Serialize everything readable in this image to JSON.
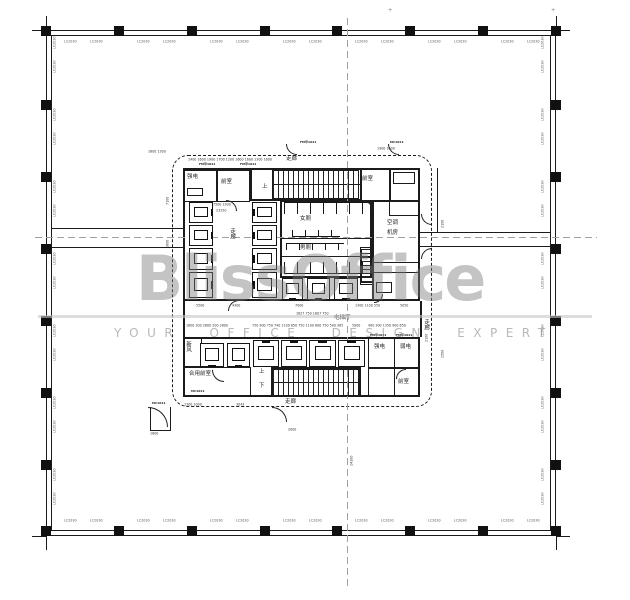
{
  "watermark": {
    "brand": "BlissOffice",
    "tagline": "YOUR OFFICE DESIGN EXPERT",
    "color": "#7d7d7d"
  },
  "colors": {
    "line": "#1b1b1b",
    "thin": "#333333",
    "centerline": "#a0a0a0",
    "tag": "#555555",
    "watermark_bar": "#c6c6c6"
  },
  "plan": {
    "building": {
      "outer_rect": [
        46,
        30,
        510,
        506,
        1.2
      ],
      "inner_rect": [
        51,
        35,
        500,
        496,
        0.8
      ]
    },
    "rects": [
      {
        "x": 183,
        "y": 168,
        "w": 237,
        "h": 133,
        "t": 2.5,
        "n": "core-top-block"
      },
      {
        "x": 183,
        "y": 337,
        "w": 237,
        "h": 60,
        "t": 2.5,
        "n": "core-bottom-band"
      },
      {
        "x": 183,
        "y": 170,
        "w": 34,
        "h": 32,
        "t": 1.8,
        "n": "room-strong-electric"
      },
      {
        "x": 217,
        "y": 170,
        "w": 33,
        "h": 32,
        "t": 1.8,
        "n": "room-anteroom"
      },
      {
        "x": 250,
        "y": 168,
        "w": 112,
        "h": 33,
        "t": 2,
        "n": "stair-top-box"
      },
      {
        "x": 360,
        "y": 168,
        "w": 31,
        "h": 33,
        "t": 1.8,
        "n": "room-anteroom-right"
      },
      {
        "x": 389,
        "y": 168,
        "w": 31,
        "h": 48,
        "t": 1.8,
        "n": "room-shaft-right"
      },
      {
        "x": 280,
        "y": 200,
        "w": 92,
        "h": 78,
        "t": 2,
        "n": "toilet-zone"
      },
      {
        "x": 372,
        "y": 200,
        "w": 48,
        "h": 101,
        "t": 2.2,
        "n": "room-ac-plant"
      },
      {
        "x": 360,
        "y": 247,
        "w": 14,
        "h": 38,
        "t": 1.5,
        "n": "shaft-small"
      },
      {
        "x": 183,
        "y": 337,
        "w": 19,
        "h": 30,
        "t": 1.6,
        "n": "room-fresh-air"
      },
      {
        "x": 183,
        "y": 367,
        "w": 68,
        "h": 30,
        "t": 1.8,
        "n": "room-shared-anteroom"
      },
      {
        "x": 368,
        "y": 337,
        "w": 27,
        "h": 31,
        "t": 1.8,
        "n": "room-strong-electric-2"
      },
      {
        "x": 394,
        "y": 337,
        "w": 26,
        "h": 31,
        "t": 1.8,
        "n": "room-weak-electric"
      },
      {
        "x": 368,
        "y": 368,
        "w": 27,
        "h": 29,
        "t": 1.6,
        "n": "room-pantry"
      },
      {
        "x": 394,
        "y": 368,
        "w": 26,
        "h": 29,
        "t": 1.6,
        "n": "room-anteroom-bottom"
      },
      {
        "x": 271,
        "y": 367,
        "w": 90,
        "h": 30,
        "t": 2,
        "n": "stair-bottom-box"
      },
      {
        "x": 187,
        "y": 188,
        "w": 16,
        "h": 8,
        "t": 1,
        "n": "equipment-box"
      },
      {
        "x": 393,
        "y": 172,
        "w": 22,
        "h": 12,
        "t": 1,
        "n": "equipment-box"
      },
      {
        "x": 376,
        "y": 282,
        "w": 16,
        "h": 11,
        "t": 1.2,
        "n": "equipment-box"
      }
    ],
    "dashed_rect": {
      "x": 172,
      "y": 155,
      "w": 260,
      "h": 252,
      "n": "smoke-control-dashed-line"
    },
    "hlines": [
      [
        51,
        228,
        132,
        1.4
      ],
      [
        51,
        247,
        132,
        1.0
      ],
      [
        420,
        232,
        131,
        1.4
      ],
      [
        420,
        246,
        131,
        1.0
      ],
      [
        272,
        184,
        88,
        1.0
      ],
      [
        272,
        382,
        88,
        1.0
      ],
      [
        280,
        238,
        92,
        1.0
      ],
      [
        280,
        256,
        92,
        0.8
      ],
      [
        374,
        262,
        44,
        0.8
      ],
      [
        374,
        272,
        44,
        0.8
      ],
      [
        32,
        30,
        14,
        1.0
      ],
      [
        556,
        30,
        14,
        1.0
      ],
      [
        32,
        536,
        14,
        1.0
      ],
      [
        556,
        536,
        14,
        1.0
      ],
      [
        150,
        430,
        20,
        0.8
      ]
    ],
    "vlines": [
      [
        46,
        16,
        14,
        1.0
      ],
      [
        556,
        16,
        14,
        1.0
      ],
      [
        46,
        536,
        14,
        1.0
      ],
      [
        556,
        536,
        14,
        1.0
      ],
      [
        437,
        168,
        65,
        1.2
      ],
      [
        183,
        301,
        36,
        2.0
      ],
      [
        420,
        301,
        36,
        2.0
      ],
      [
        150,
        407,
        24,
        1.0
      ],
      [
        170,
        407,
        24,
        1.0
      ]
    ],
    "centerlines": {
      "v": [
        347,
        18,
        570
      ],
      "h": [
        35,
        237,
        562
      ]
    },
    "columns": {
      "top_y": 26,
      "bottom_y": 526,
      "left_x": 41,
      "right_x": 551,
      "size": 10,
      "xs": [
        46,
        119,
        192,
        265,
        337,
        410,
        483,
        556
      ],
      "ys": [
        33,
        105,
        177,
        249,
        321,
        393,
        465,
        533
      ]
    },
    "window_tags": {
      "text": "LC2030",
      "items": [
        [
          64,
          40,
          0
        ],
        [
          90,
          40,
          0
        ],
        [
          137,
          40,
          0
        ],
        [
          163,
          40,
          0
        ],
        [
          210,
          40,
          0
        ],
        [
          236,
          40,
          0
        ],
        [
          283,
          40,
          0
        ],
        [
          309,
          40,
          0
        ],
        [
          355,
          40,
          0
        ],
        [
          381,
          40,
          0
        ],
        [
          428,
          40,
          0
        ],
        [
          454,
          40,
          0
        ],
        [
          501,
          40,
          0
        ],
        [
          527,
          40,
          0
        ],
        [
          64,
          519,
          0
        ],
        [
          90,
          519,
          0
        ],
        [
          137,
          519,
          0
        ],
        [
          163,
          519,
          0
        ],
        [
          210,
          519,
          0
        ],
        [
          236,
          519,
          0
        ],
        [
          283,
          519,
          0
        ],
        [
          309,
          519,
          0
        ],
        [
          355,
          519,
          0
        ],
        [
          381,
          519,
          0
        ],
        [
          428,
          519,
          0
        ],
        [
          454,
          519,
          0
        ],
        [
          501,
          519,
          0
        ],
        [
          527,
          519,
          0
        ],
        [
          53,
          49,
          1
        ],
        [
          53,
          73,
          1
        ],
        [
          53,
          121,
          1
        ],
        [
          53,
          145,
          1
        ],
        [
          53,
          193,
          1
        ],
        [
          53,
          217,
          1
        ],
        [
          53,
          265,
          1
        ],
        [
          53,
          289,
          1
        ],
        [
          53,
          337,
          1
        ],
        [
          53,
          361,
          1
        ],
        [
          53,
          409,
          1
        ],
        [
          53,
          433,
          1
        ],
        [
          53,
          481,
          1
        ],
        [
          53,
          505,
          1
        ],
        [
          541,
          49,
          1
        ],
        [
          541,
          73,
          1
        ],
        [
          541,
          121,
          1
        ],
        [
          541,
          145,
          1
        ],
        [
          541,
          193,
          1
        ],
        [
          541,
          217,
          1
        ],
        [
          541,
          265,
          1
        ],
        [
          541,
          289,
          1
        ],
        [
          541,
          337,
          1
        ],
        [
          541,
          361,
          1
        ],
        [
          541,
          409,
          1
        ],
        [
          541,
          433,
          1
        ],
        [
          541,
          481,
          1
        ],
        [
          541,
          505,
          1
        ]
      ]
    },
    "stairs": [
      {
        "x": 272,
        "y": 170,
        "w": 87,
        "h": 29,
        "dir": "v",
        "n": "stair-top"
      },
      {
        "x": 272,
        "y": 369,
        "w": 87,
        "h": 27,
        "dir": "v",
        "n": "stair-bottom"
      },
      {
        "x": 361,
        "y": 249,
        "w": 12,
        "h": 34,
        "dir": "h",
        "n": "stair-side"
      }
    ],
    "elevators": [
      {
        "x": 189,
        "y": 202,
        "w": 24,
        "h": 21,
        "d": "right"
      },
      {
        "x": 189,
        "y": 225,
        "w": 24,
        "h": 21,
        "d": "right"
      },
      {
        "x": 189,
        "y": 248,
        "w": 24,
        "h": 22,
        "d": "right"
      },
      {
        "x": 189,
        "y": 272,
        "w": 24,
        "h": 26,
        "d": "right"
      },
      {
        "x": 252,
        "y": 202,
        "w": 25,
        "h": 21,
        "d": "left"
      },
      {
        "x": 252,
        "y": 225,
        "w": 25,
        "h": 21,
        "d": "left"
      },
      {
        "x": 252,
        "y": 248,
        "w": 25,
        "h": 22,
        "d": "left"
      },
      {
        "x": 252,
        "y": 272,
        "w": 25,
        "h": 26,
        "d": "left"
      },
      {
        "x": 282,
        "y": 278,
        "w": 21,
        "h": 22,
        "d": "down"
      },
      {
        "x": 307,
        "y": 278,
        "w": 23,
        "h": 22,
        "d": "down"
      },
      {
        "x": 334,
        "y": 278,
        "w": 24,
        "h": 22,
        "d": "down"
      },
      {
        "x": 253,
        "y": 340,
        "w": 26,
        "h": 27,
        "d": "up"
      },
      {
        "x": 281,
        "y": 340,
        "w": 26,
        "h": 27,
        "d": "up"
      },
      {
        "x": 309,
        "y": 340,
        "w": 27,
        "h": 27,
        "d": "up"
      },
      {
        "x": 338,
        "y": 340,
        "w": 27,
        "h": 27,
        "d": "up"
      },
      {
        "x": 200,
        "y": 343,
        "w": 24,
        "h": 24,
        "d": "down"
      },
      {
        "x": 227,
        "y": 343,
        "w": 23,
        "h": 24,
        "d": "down"
      }
    ],
    "combs": [
      {
        "x": 284,
        "y": 202,
        "w": 86,
        "h": 12,
        "side": "t",
        "n": "toilet-stalls-women"
      },
      {
        "x": 292,
        "y": 230,
        "w": 48,
        "h": 7,
        "side": "b",
        "n": "toilet-sinks"
      },
      {
        "x": 286,
        "y": 243,
        "w": 58,
        "h": 7,
        "side": "t",
        "n": "toilet-urinals"
      },
      {
        "x": 284,
        "y": 262,
        "w": 86,
        "h": 12,
        "side": "b",
        "n": "toilet-stalls-men"
      }
    ],
    "arcs": [
      [
        286,
        144,
        11,
        "bl"
      ],
      [
        388,
        144,
        11,
        "bl"
      ],
      [
        272,
        407,
        15,
        "tr"
      ],
      [
        148,
        407,
        20,
        "tr"
      ],
      [
        421,
        214,
        11,
        "bl"
      ],
      [
        421,
        248,
        11,
        "tl"
      ],
      [
        226,
        200,
        11,
        "tr"
      ],
      [
        362,
        200,
        11,
        "tr"
      ],
      [
        212,
        370,
        12,
        "bl"
      ],
      [
        396,
        369,
        10,
        "tl"
      ],
      [
        228,
        300,
        11,
        "tl"
      ],
      [
        374,
        294,
        9,
        "br"
      ]
    ],
    "room_labels": [
      {
        "t": "强电",
        "x": 187,
        "y": 174
      },
      {
        "t": "前室",
        "x": 221,
        "y": 179
      },
      {
        "t": "走廊",
        "x": 286,
        "y": 156
      },
      {
        "t": "上",
        "x": 262,
        "y": 184
      },
      {
        "t": "前室",
        "x": 362,
        "y": 176
      },
      {
        "t": "走廊",
        "x": 229,
        "y": 228,
        "v": 1
      },
      {
        "t": "女厕",
        "x": 300,
        "y": 216
      },
      {
        "t": "男厕",
        "x": 300,
        "y": 245
      },
      {
        "t": "空调",
        "x": 387,
        "y": 220
      },
      {
        "t": "机房",
        "x": 387,
        "y": 230
      },
      {
        "t": "强电",
        "x": 374,
        "y": 344
      },
      {
        "t": "弱电",
        "x": 400,
        "y": 344
      },
      {
        "t": "前室",
        "x": 398,
        "y": 379
      },
      {
        "t": "合用前室",
        "x": 189,
        "y": 371
      },
      {
        "t": "上",
        "x": 259,
        "y": 369
      },
      {
        "t": "下",
        "x": 259,
        "y": 383
      },
      {
        "t": "走廊",
        "x": 285,
        "y": 399
      },
      {
        "t": "走廊",
        "x": 423,
        "y": 319,
        "v": 1
      },
      {
        "t": "电梯厅",
        "x": 334,
        "y": 315
      },
      {
        "t": "新风",
        "x": 185,
        "y": 341,
        "v": 1
      }
    ],
    "dim_texts": [
      {
        "t": "1400 1600 1900 1700 1200 1600 1600 1300 1600",
        "x": 188,
        "y": 158
      },
      {
        "t": "5500",
        "x": 196,
        "y": 304
      },
      {
        "t": "4300",
        "x": 232,
        "y": 304
      },
      {
        "t": "7000",
        "x": 295,
        "y": 304
      },
      {
        "t": "1300 1100 550",
        "x": 355,
        "y": 304
      },
      {
        "t": "5050",
        "x": 400,
        "y": 304
      },
      {
        "t": "1627 750 1607 750",
        "x": 296,
        "y": 312
      },
      {
        "t": "1800 200 2800 200 2800",
        "x": 186,
        "y": 324
      },
      {
        "t": "750 900 750 740 1100 850 750 1100 800 750 500 365",
        "x": 252,
        "y": 324
      },
      {
        "t": "5000",
        "x": 352,
        "y": 324
      },
      {
        "t": "400 300 1350 900 650",
        "x": 368,
        "y": 324
      },
      {
        "t": "2000",
        "x": 288,
        "y": 428
      },
      {
        "t": "1800",
        "x": 150,
        "y": 432
      },
      {
        "t": "1300 1000",
        "x": 184,
        "y": 403
      },
      {
        "t": "3043",
        "x": 236,
        "y": 403
      },
      {
        "t": "1900 1600",
        "x": 377,
        "y": 147
      },
      {
        "t": "1600 1300",
        "x": 148,
        "y": 150
      },
      {
        "t": "7500 1900",
        "x": 213,
        "y": 203
      },
      {
        "t": "23250",
        "x": 216,
        "y": 209
      },
      {
        "t": "7100",
        "x": 166,
        "y": 205,
        "r": 1
      },
      {
        "t": "1600",
        "x": 166,
        "y": 248,
        "r": 1
      },
      {
        "t": "2100",
        "x": 441,
        "y": 228,
        "r": 1
      },
      {
        "t": "2100",
        "x": 425,
        "y": 342,
        "r": 1
      },
      {
        "t": "1500",
        "x": 441,
        "y": 358,
        "r": 1
      },
      {
        "t": "14100",
        "x": 350,
        "y": 466,
        "r": 1
      }
    ],
    "door_tags": [
      {
        "t": "FM甲1021",
        "x": 199,
        "y": 163
      },
      {
        "t": "FM甲1021",
        "x": 240,
        "y": 163
      },
      {
        "t": "FM甲1021",
        "x": 300,
        "y": 141
      },
      {
        "t": "MC1021",
        "x": 390,
        "y": 141
      },
      {
        "t": "FM甲1021",
        "x": 370,
        "y": 334
      },
      {
        "t": "FM甲1021",
        "x": 396,
        "y": 334
      },
      {
        "t": "MC1021",
        "x": 191,
        "y": 390
      },
      {
        "t": "MC1021",
        "x": 152,
        "y": 402
      }
    ],
    "crosses": [
      [
        388,
        8
      ],
      [
        551,
        8
      ]
    ]
  }
}
